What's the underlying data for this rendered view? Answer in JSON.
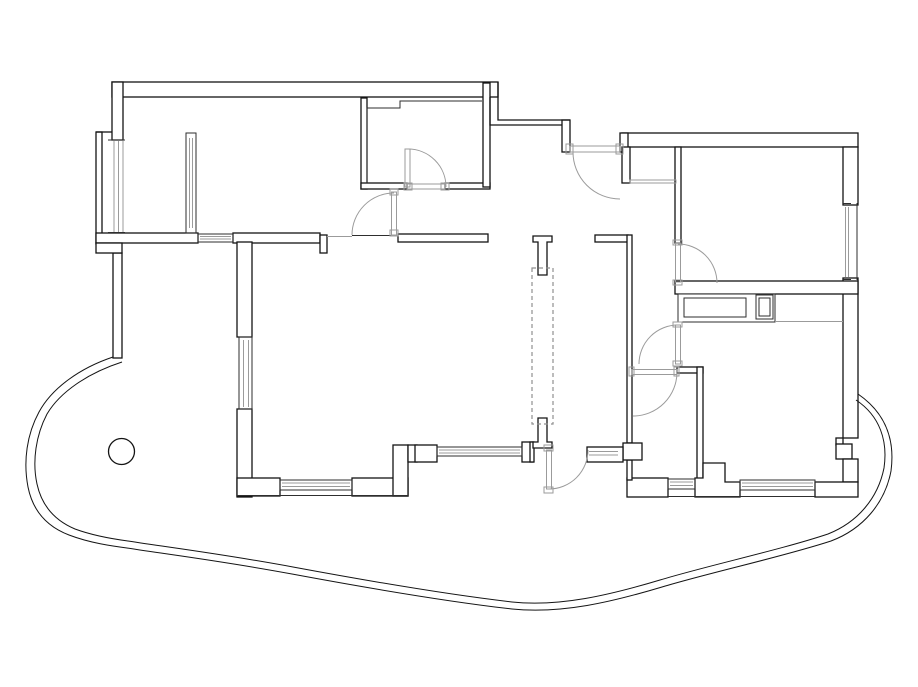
{
  "canvas": {
    "width": 918,
    "height": 687,
    "background": "#ffffff"
  },
  "colors": {
    "wall": "#141414",
    "thin": "#2e2e2e",
    "gray": "#9b9b9b",
    "dashed": "#8f8f8f",
    "fill": "#ffffff"
  },
  "plan": {
    "walls": {
      "rects": [
        {
          "n": "top-wall-left",
          "r": [
            112,
            82,
            386,
            15
          ]
        },
        {
          "n": "left-wall-upper",
          "r": [
            112,
            82,
            11,
            58
          ]
        },
        {
          "n": "left-outer-step",
          "r": [
            96,
            132,
            6,
            112
          ]
        },
        {
          "n": "bottom-wall-loggia",
          "r": [
            96,
            233,
            102,
            10
          ]
        },
        {
          "n": "bottom-wall-bedroom1",
          "r": [
            233,
            233,
            87,
            10
          ]
        },
        {
          "n": "stub-bedroom1",
          "r": [
            320,
            235,
            7,
            18
          ]
        },
        {
          "n": "wall-top-living",
          "r": [
            398,
            234,
            90,
            8
          ]
        },
        {
          "n": "wall-hall-top-right",
          "r": [
            595,
            235,
            33,
            7
          ]
        },
        {
          "n": "closet-left-wall",
          "r": [
            361,
            98,
            6,
            91
          ]
        },
        {
          "n": "closet-bottom-left",
          "r": [
            361,
            183,
            46,
            6
          ]
        },
        {
          "n": "closet-bottom-right",
          "r": [
            445,
            183,
            45,
            6
          ]
        },
        {
          "n": "hall-left-wall",
          "r": [
            483,
            83,
            7,
            104
          ]
        },
        {
          "n": "entrance-jamb-left",
          "r": [
            562,
            120,
            8,
            32
          ]
        },
        {
          "n": "top-wall-right",
          "r": [
            622,
            133,
            236,
            14
          ]
        },
        {
          "n": "entrance-jamb-right",
          "r": [
            620,
            133,
            8,
            19
          ]
        },
        {
          "n": "nook-wall",
          "r": [
            622,
            147,
            8,
            36
          ]
        },
        {
          "n": "bedroom2-left-wall",
          "r": [
            675,
            147,
            6,
            96
          ]
        },
        {
          "n": "right-wall-upper",
          "r": [
            843,
            147,
            15,
            58
          ]
        },
        {
          "n": "right-wall-mid",
          "r": [
            843,
            278,
            15,
            160
          ]
        },
        {
          "n": "right-wall-notch",
          "r": [
            836,
            438,
            7,
            7
          ]
        },
        {
          "n": "right-square-column",
          "r": [
            836,
            444,
            16,
            15
          ]
        },
        {
          "n": "right-wall-lower",
          "r": [
            843,
            459,
            15,
            23
          ]
        },
        {
          "n": "bedroom2-bottom-wall",
          "r": [
            675,
            281,
            183,
            13
          ]
        },
        {
          "n": "hall-right-wall",
          "r": [
            627,
            235,
            5,
            208
          ]
        },
        {
          "n": "bath-top-stub",
          "r": [
            677,
            367,
            26,
            6
          ]
        },
        {
          "n": "bath-right-wall",
          "r": [
            697,
            367,
            6,
            113
          ]
        },
        {
          "n": "bath-bottom-wall",
          "r": [
            627,
            478,
            41,
            19
          ]
        },
        {
          "n": "hall-column-wall",
          "r": [
            627,
            460,
            5,
            20
          ]
        },
        {
          "n": "bottom-wall-right",
          "r": [
            815,
            482,
            43,
            15
          ]
        },
        {
          "n": "living-left-wall-upper",
          "r": [
            237,
            242,
            15,
            95
          ]
        },
        {
          "n": "living-left-wall-lower",
          "r": [
            237,
            409,
            15,
            88
          ]
        },
        {
          "n": "living-bottom-left",
          "r": [
            237,
            478,
            43,
            18
          ]
        },
        {
          "n": "living-bottom-right",
          "r": [
            352,
            478,
            56,
            18
          ]
        },
        {
          "n": "step-column",
          "r": [
            393,
            445,
            15,
            51
          ]
        },
        {
          "n": "stub-x408",
          "r": [
            408,
            445,
            9,
            17
          ]
        },
        {
          "n": "mid-square-column",
          "r": [
            415,
            445,
            22,
            17
          ]
        },
        {
          "n": "stub-x522",
          "r": [
            522,
            442,
            11,
            20
          ]
        },
        {
          "n": "hall-bottom-left-stub",
          "r": [
            530,
            442,
            4,
            20
          ]
        },
        {
          "n": "left-wall-lower",
          "r": [
            113,
            253,
            9,
            105
          ]
        },
        {
          "n": "left-step2",
          "r": [
            96,
            243,
            26,
            10
          ]
        },
        {
          "n": "square-column-623",
          "r": [
            623,
            443,
            19,
            17
          ]
        },
        {
          "n": "sidelight-frame",
          "r": [
            587,
            447,
            36,
            15
          ]
        }
      ],
      "paths": [
        {
          "n": "entrance-step-outer",
          "d": "M498,82 L498,120 L570,120"
        },
        {
          "n": "entrance-step-inner",
          "d": "M490,97 L490,125 L562,125"
        },
        {
          "n": "loggia-top-line",
          "d": "M96,132 L112,132"
        },
        {
          "n": "kitchen-pier",
          "d": "M695,497 L695,478 L703,478 L703,463 L725,463 L725,482 L740,482 L740,497 Z",
          "f": 1
        },
        {
          "n": "t-column-top",
          "d": "M533,242 L533,236 L552,236 L552,242 L547,242 L547,275 L538,275 L538,242 Z",
          "f": 1
        },
        {
          "n": "t-column-bottom",
          "d": "M533,442 L538,442 L538,418 L547,418 L547,442 L552,442 L552,448 L533,448 Z",
          "f": 1
        }
      ]
    },
    "thin": {
      "rects": [
        {
          "n": "closet-cabinet-outline",
          "r": [
            678,
            294,
            97,
            28
          ],
          "f": 1
        },
        {
          "n": "closet-cabinet-inner",
          "r": [
            684,
            298,
            62,
            19
          ]
        },
        {
          "n": "closet-duct",
          "r": [
            756,
            295,
            17,
            24
          ]
        },
        {
          "n": "closet-duct-inner",
          "r": [
            759,
            298,
            11,
            18
          ]
        }
      ],
      "paths": [
        {
          "n": "closet-room-outline",
          "d": "M367,183 L367,108 L400,108 L400,101 L482,101"
        },
        {
          "n": "under-arc-line",
          "d": "M352,235.5 L392,235.5"
        },
        {
          "n": "bottom-face-right",
          "d": "M668,496.5 L815,496.5"
        },
        {
          "n": "bottom-face-living",
          "d": "M237,495.5 L408,495.5"
        },
        {
          "n": "right-wall-outer-face",
          "d": "M857,203 L857,280"
        }
      ]
    },
    "gray": {
      "rects": [
        {
          "n": "vestibule-threshold",
          "r": [
            630,
            180,
            46,
            3
          ]
        }
      ],
      "paths": [
        {
          "n": "opening-line-y237",
          "d": "M327,236.5 L352,236.5"
        },
        {
          "n": "kitchen-counter-line",
          "d": "M775,321.5 L843,321.5"
        }
      ]
    },
    "windows": [
      {
        "n": "window-loggia-left",
        "frame": null,
        "bars": [
          [
            108,
            140,
            125,
            140
          ],
          [
            108,
            232.5,
            125,
            232.5
          ]
        ],
        "glass": [
          [
            114,
            141,
            114,
            232
          ],
          [
            118.5,
            141,
            118.5,
            232
          ],
          [
            123,
            141,
            123,
            232
          ]
        ]
      },
      {
        "n": "window-loggia-inner",
        "frame": [
          186,
          133,
          10,
          100
        ],
        "bars": [],
        "glass": [
          [
            189.5,
            138,
            189.5,
            228
          ],
          [
            192.5,
            138,
            192.5,
            228
          ]
        ]
      },
      {
        "n": "window-bedroom1-bottom",
        "frame": [
          198,
          234,
          35,
          8
        ],
        "bars": [],
        "glass": [
          [
            200,
            236.5,
            231,
            236.5
          ],
          [
            200,
            239,
            231,
            239
          ]
        ]
      },
      {
        "n": "window-living-left",
        "frame": [
          239,
          337,
          13,
          72
        ],
        "bars": [],
        "glass": [
          [
            243.5,
            340,
            243.5,
            407
          ],
          [
            248.5,
            340,
            248.5,
            407
          ]
        ]
      },
      {
        "n": "window-living-bottom",
        "frame": [
          280,
          480,
          72,
          10
        ],
        "bars": [],
        "glass": [
          [
            282,
            483,
            350,
            483
          ],
          [
            282,
            486.5,
            350,
            486.5
          ]
        ]
      },
      {
        "n": "window-hall-bottom",
        "frame": [
          437,
          447,
          85,
          9
        ],
        "bars": [],
        "glass": [
          [
            439,
            450,
            520,
            450
          ],
          [
            439,
            453,
            520,
            453
          ]
        ]
      },
      {
        "n": "window-bath-bottom",
        "frame": [
          668,
          479,
          27,
          10
        ],
        "bars": [],
        "glass": [
          [
            670,
            482,
            693,
            482
          ],
          [
            670,
            485.5,
            693,
            485.5
          ]
        ]
      },
      {
        "n": "window-kitchen-bottom",
        "frame": [
          740,
          480,
          75,
          10
        ],
        "bars": [],
        "glass": [
          [
            742,
            483,
            813,
            483
          ],
          [
            742,
            486.5,
            813,
            486.5
          ]
        ]
      },
      {
        "n": "window-bedroom2-right",
        "frame": null,
        "bars": [
          [
            843,
            203.5,
            851,
            203.5
          ],
          [
            843,
            279.5,
            851,
            279.5
          ]
        ],
        "glass": [
          [
            845.5,
            207,
            845.5,
            277
          ],
          [
            848.5,
            207,
            848.5,
            277
          ]
        ]
      },
      {
        "n": "sidelight-glass",
        "frame": null,
        "bars": [],
        "glass": [
          [
            589,
            451.5,
            618,
            451.5
          ],
          [
            589,
            455,
            618,
            455
          ]
        ]
      }
    ],
    "doors": [
      {
        "n": "door-closet",
        "leaf": [
          405,
          149,
          5,
          38
        ],
        "arc": [
          408,
          187,
          38,
          -90,
          0
        ],
        "jambs": [
          [
            404,
            183,
            8,
            7
          ],
          [
            441,
            183,
            8,
            7
          ]
        ],
        "threshold": [
          407,
          184,
          38,
          5
        ]
      },
      {
        "n": "door-corridor",
        "leaf": [
          391.5,
          192,
          5,
          43
        ],
        "arc": [
          394,
          235,
          42,
          -90,
          -180
        ],
        "jambs": [
          [
            390,
            189,
            8,
            6
          ],
          [
            390,
            230,
            8,
            6
          ]
        ],
        "threshold": null
      },
      {
        "n": "door-entrance",
        "leaf": [
          570,
          146,
          50,
          6
        ],
        "arc": [
          620,
          152,
          47,
          180,
          90
        ],
        "jambs": [
          [
            566,
            144,
            7,
            10
          ],
          [
            616,
            144,
            7,
            10
          ]
        ],
        "threshold": null
      },
      {
        "n": "door-bedroom-right",
        "leaf": [
          675.5,
          243,
          5,
          39
        ],
        "arc": [
          678,
          283,
          39,
          -90,
          0
        ],
        "jambs": [
          [
            673,
            240,
            9,
            5
          ],
          [
            673,
            280,
            9,
            5
          ]
        ],
        "threshold": null
      },
      {
        "n": "door-kitchen",
        "leaf": [
          675.5,
          325,
          5,
          39
        ],
        "arc": [
          678,
          364,
          39,
          -90,
          -180
        ],
        "jambs": [
          [
            673,
            322,
            9,
            5
          ],
          [
            673,
            361,
            9,
            5
          ]
        ],
        "threshold": null
      },
      {
        "n": "door-bathroom",
        "leaf": [
          632,
          369.5,
          45,
          5
        ],
        "arc": [
          633,
          372,
          44,
          0,
          90
        ],
        "jambs": [
          [
            629,
            367,
            5,
            9
          ],
          [
            674,
            367,
            5,
            9
          ]
        ],
        "threshold": null
      },
      {
        "n": "door-balcony",
        "leaf": [
          546.5,
          450,
          5,
          39
        ],
        "arc": [
          549,
          450,
          39,
          90,
          0
        ],
        "jambs": [
          [
            544,
            445,
            9,
            6
          ],
          [
            544,
            487,
            9,
            6
          ]
        ],
        "threshold": null
      }
    ],
    "dashed_rects": [
      {
        "n": "elevator-shaft",
        "r": [
          532,
          268,
          21,
          156
        ]
      }
    ],
    "balcony": {
      "outer": "M113,357 C80,368 52,388 39,412 C27,434 23,461 28,487 C33,512 48,527 69,535 C90,543 112,546 127,548 C172,555 222,561 292,574 C362,587 442,601 512,609 C562,614 612,602 662,587 C712,572 782,557 831,541 C863,529 885,503 891,471 C895,441 887,414 858,394",
      "inner": "M122,362 C88,373 60,392 47,414 C36,435 32,461 37,484 C42,507 56,521 75,529 C94,536 113,539 128,541 C173,548 223,554 293,567 C363,580 443,594 512,602 C560,607 610,595 660,580 C710,565 780,550 828,534 C858,522 878,498 884,468 C888,441 880,416 856,400"
    },
    "circles": [
      {
        "n": "round-column",
        "c": [
          121.5,
          451.5,
          13
        ]
      }
    ]
  }
}
